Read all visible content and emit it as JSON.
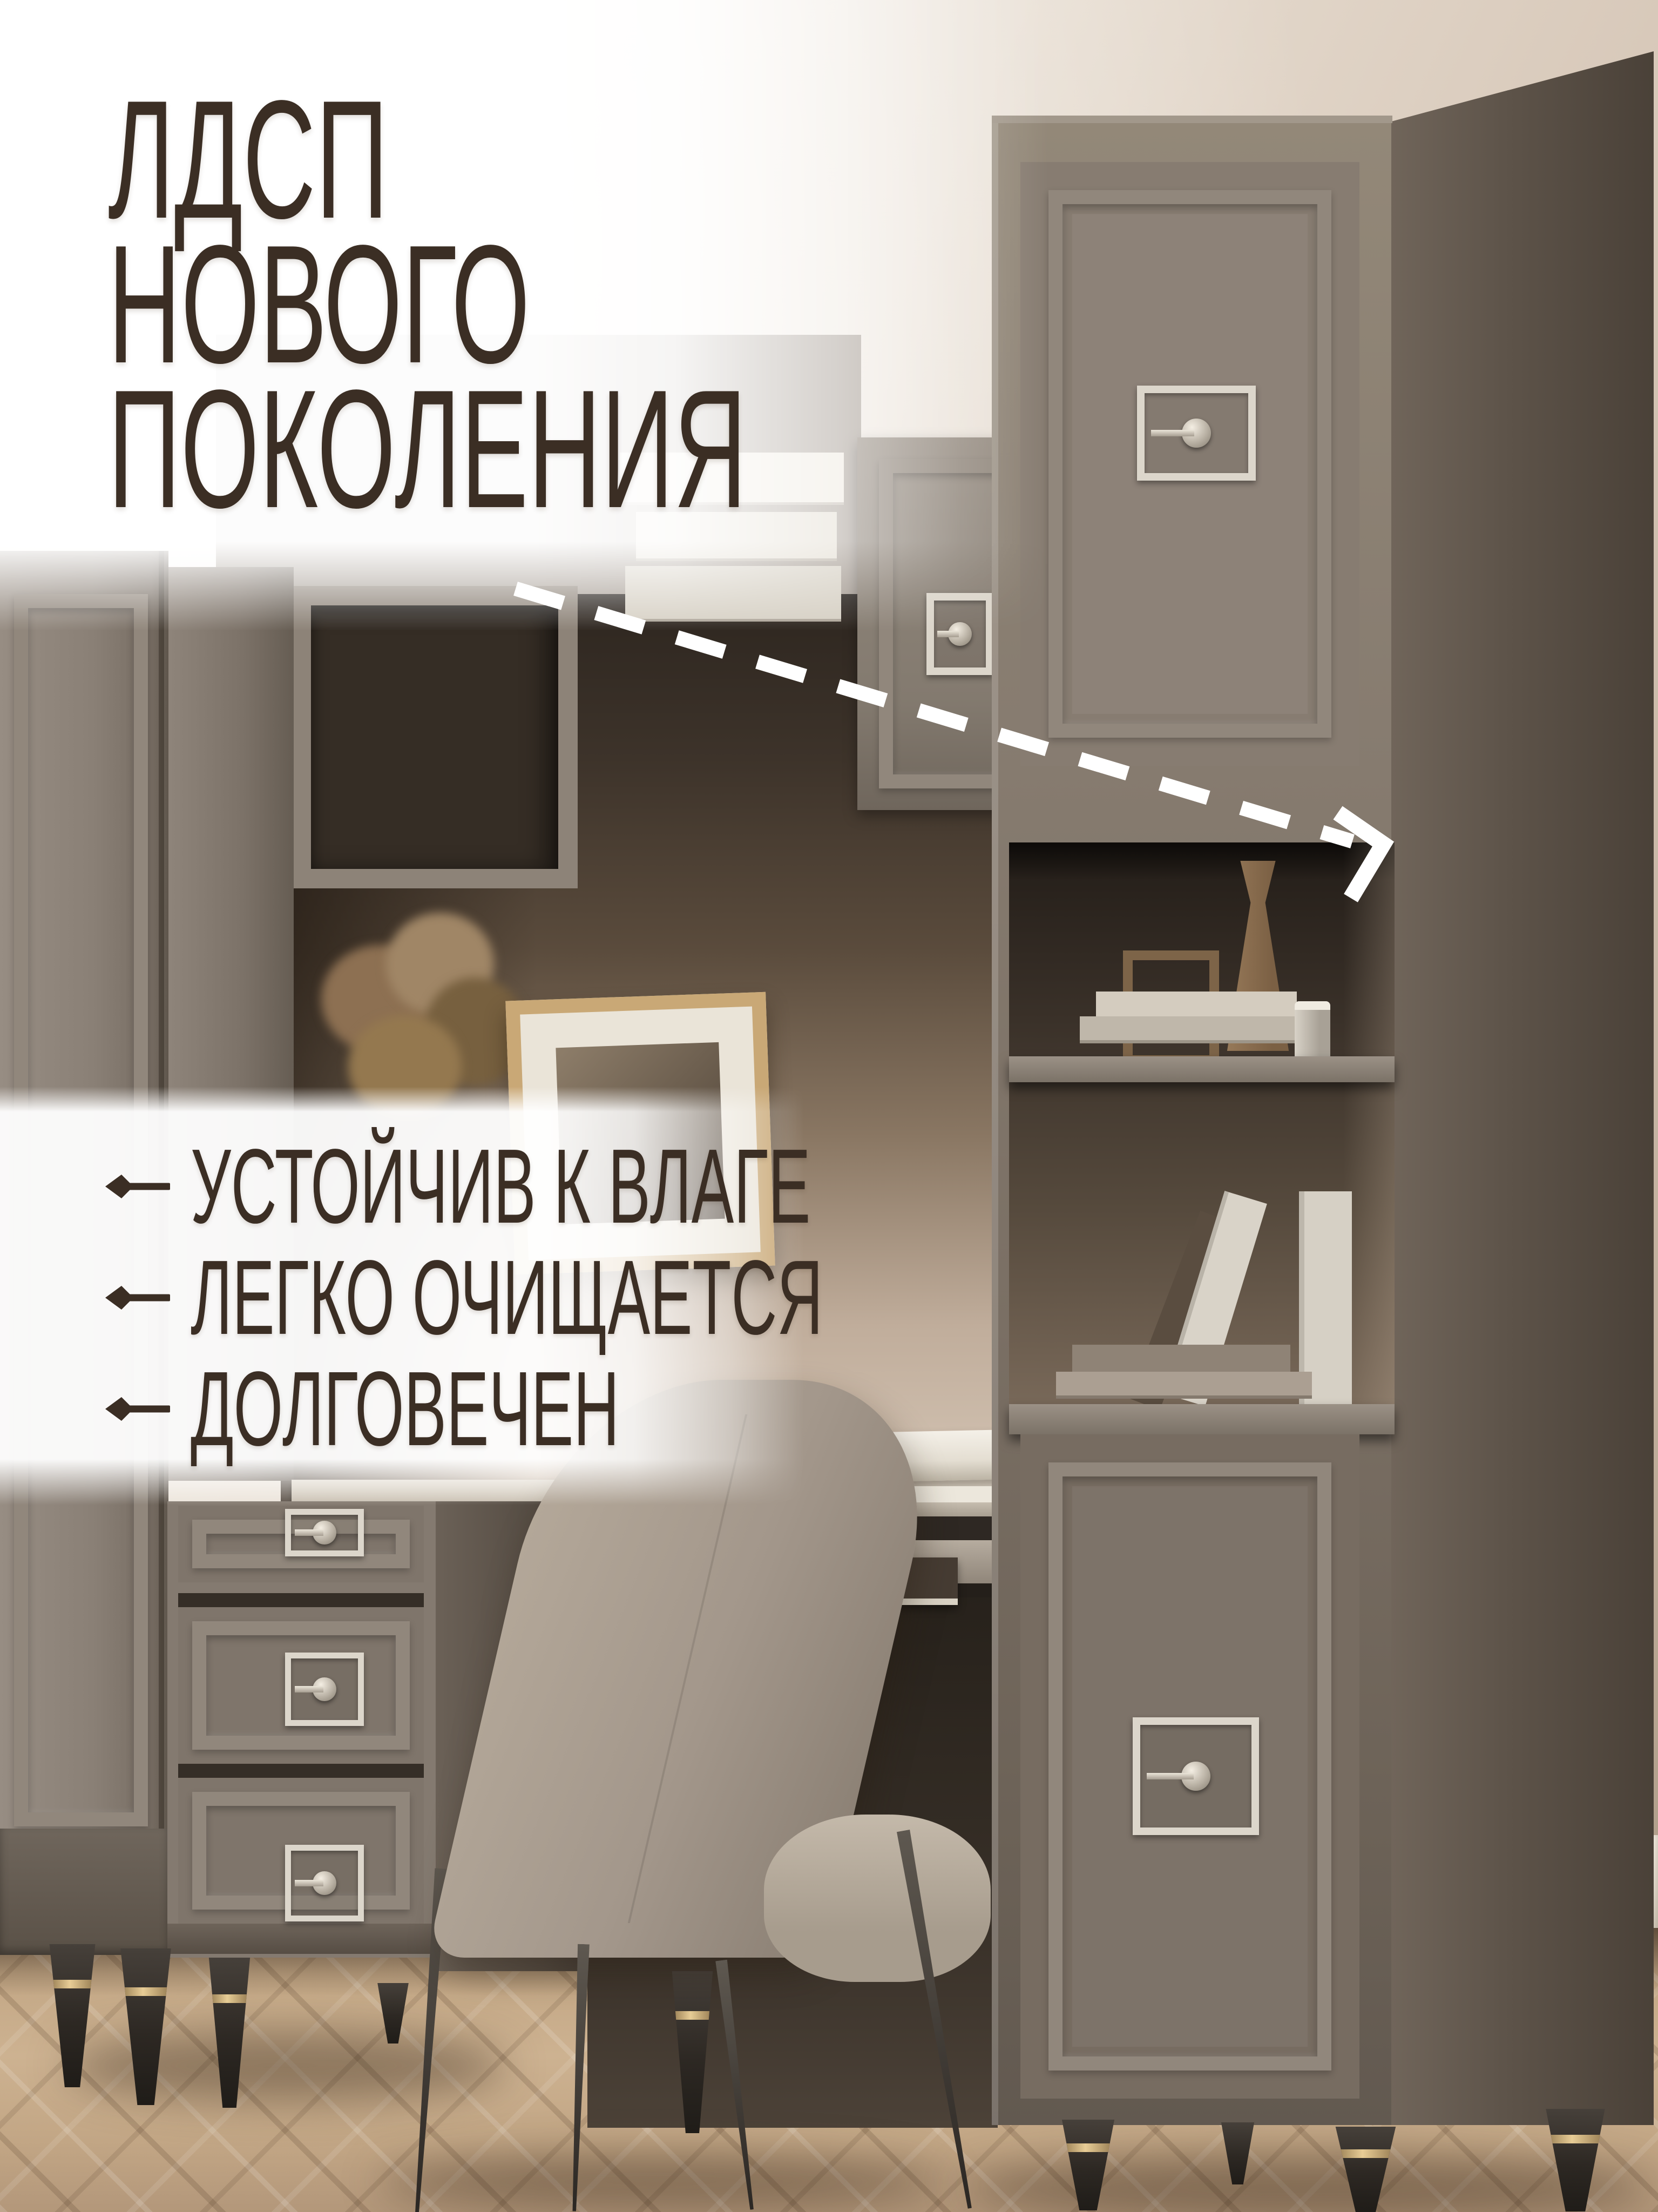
{
  "title": {
    "lines": [
      "ЛДСП",
      "НОВОГО",
      "ПОКОЛЕНИЯ"
    ]
  },
  "features": {
    "items": [
      {
        "icon": "left-arrow-icon",
        "label": "УСТОЙЧИВ К ВЛАГЕ"
      },
      {
        "icon": "left-arrow-icon",
        "label": "ЛЕГКО ОЧИЩАЕТСЯ"
      },
      {
        "icon": "left-arrow-icon",
        "label": "ДОЛГОВЕЧЕН"
      }
    ]
  },
  "pointer": {
    "icon": "dashed-arrow-icon"
  },
  "colors": {
    "text_brown": "#3b2e24",
    "overlay_white": "#ffffff",
    "dash_white": "#ffffff",
    "furniture_grey": "#867c71",
    "furniture_side_dark": "#5e5349",
    "niche_dark": "#3c322a",
    "wall_cream": "#e5ddd3",
    "floor_oak": "#c2a583",
    "metal_silver": "#ddd7cc",
    "leg_dark": "#332e29",
    "leg_ring_gold": "#dec18f",
    "chair_greige": "#a89c8e"
  }
}
